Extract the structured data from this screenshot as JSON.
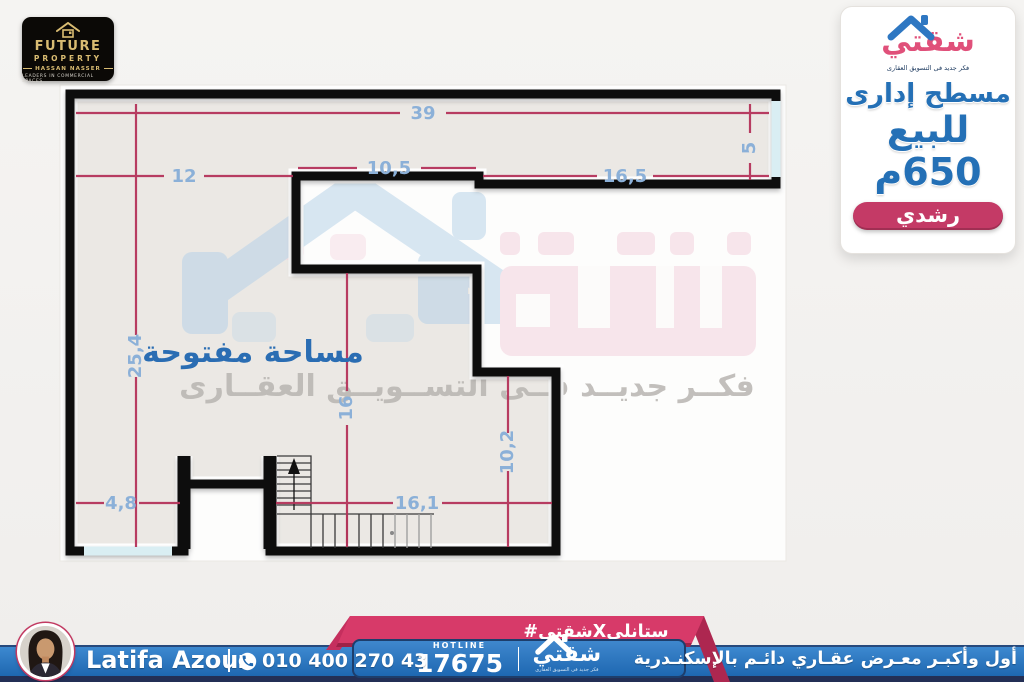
{
  "header": {
    "future_property_logo": {
      "title": "FUTURE",
      "subtitle": "PROPERTY",
      "owner": "HASSAN NASSER",
      "tagline": "LEADERS IN COMMERCIAL SPACES"
    },
    "brand_logo": {
      "name": "شقتي",
      "tagline": "فكر جديد فى التسويق العقارى"
    }
  },
  "offer_panel": {
    "type_line": "مسطح إدارى",
    "sale_line": "للبيع",
    "area": "650م",
    "district_badge": "رشدي"
  },
  "floorplan": {
    "room_label": "مساحة مفتوحة",
    "dimensions": {
      "top_total": "39",
      "left_upper": "12",
      "notch_width": "10,5",
      "right_upper": "16,5",
      "right_edge_height": "5",
      "left_height": "25,4",
      "mid_height": "16",
      "bottom_left": "4,8",
      "bottom_mid": "16,1",
      "lower_right_height": "10,2"
    }
  },
  "watermark": {
    "tagline": "فكــر جديــد فــى التســويــق العقــارى"
  },
  "footer": {
    "agent": {
      "name": "Latifa Azouz",
      "phone": "010 400 270 43"
    },
    "hashtag": "#شقتيXستانلي",
    "hotline": {
      "label": "HOTLINE",
      "number": "17675"
    },
    "brand": {
      "name": "شقتي",
      "tagline": "فكر جديد فى التسويق العقارى"
    },
    "slogan": "أول وأكبـر معـرض عقـاري دائـم بالإسكنـدرية"
  },
  "colors": {
    "accent_pink": "#d73a69",
    "brand_blue": "#2470b6",
    "bar_blue": "#2374c4",
    "navy": "#232f55",
    "dimension_line": "#b5335a",
    "dimension_label": "#8bb0d8"
  }
}
